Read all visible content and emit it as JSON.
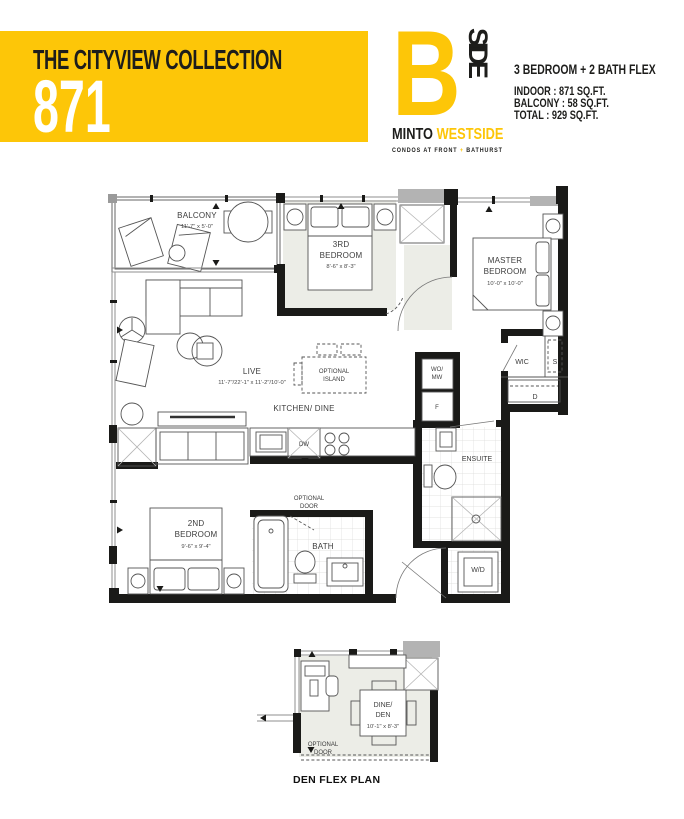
{
  "header": {
    "collection_title": "THE CITYVIEW COLLECTION",
    "unit_number": "871",
    "logo": {
      "letter_b": "B",
      "side": "SIDE",
      "brand_left": "MINTO ",
      "brand_right": "WESTSIDE",
      "tagline_left": "CONDOS AT FRONT ",
      "tagline_plus": "+",
      "tagline_right": " BATHURST"
    },
    "unit_type": "3 BEDROOM + 2 BATH FLEX",
    "areas": {
      "indoor": "INDOOR : 871 SQ.FT.",
      "balcony": "BALCONY : 58 SQ.FT.",
      "total": "TOTAL : 929 SQ.FT."
    }
  },
  "colors": {
    "accent_yellow": "#FDC608",
    "wall_black": "#1A1A18",
    "room_shade": "#ECEDE7",
    "shaft_gray": "#B3B3B3"
  },
  "main_plan": {
    "balcony": {
      "name": "BALCONY",
      "dims": "11'-7\" x 5'-0\""
    },
    "third_bedroom": {
      "name_line1": "3RD",
      "name_line2": "BEDROOM",
      "dims": "8'-6\" x 8'-3\""
    },
    "master_bedroom": {
      "name_line1": "MASTER",
      "name_line2": "BEDROOM",
      "dims": "10'-0\" x 10'-0\""
    },
    "living": {
      "name": "LIVE",
      "dims": "11'-7\"/22'-1\" x 11'-2\"/10'-0\""
    },
    "kitchen": {
      "name": "KITCHEN/ DINE"
    },
    "optional_island": {
      "line1": "OPTIONAL",
      "line2": "ISLAND"
    },
    "second_bedroom": {
      "name_line1": "2ND",
      "name_line2": "BEDROOM",
      "dims": "9'-6\" x 9'-4\""
    },
    "bath": {
      "name": "BATH"
    },
    "ensuite": {
      "name": "ENSUITE"
    },
    "optional_door": {
      "line1": "OPTIONAL",
      "line2": "DOOR"
    },
    "labels": {
      "wic": "WIC",
      "shelf": "S",
      "dresser": "D",
      "washer_dryer": "W/D",
      "wall_oven_microwave_line1": "WO/",
      "wall_oven_microwave_line2": "MW",
      "fridge": "F",
      "dishwasher": "DW"
    }
  },
  "den_plan": {
    "title": "DEN FLEX PLAN",
    "dine_den": {
      "name_line1": "DINE/",
      "name_line2": "DEN",
      "dims": "10'-1\" x 8'-3\""
    },
    "optional_door": {
      "line1": "OPTIONAL",
      "line2": "DOOR"
    }
  }
}
